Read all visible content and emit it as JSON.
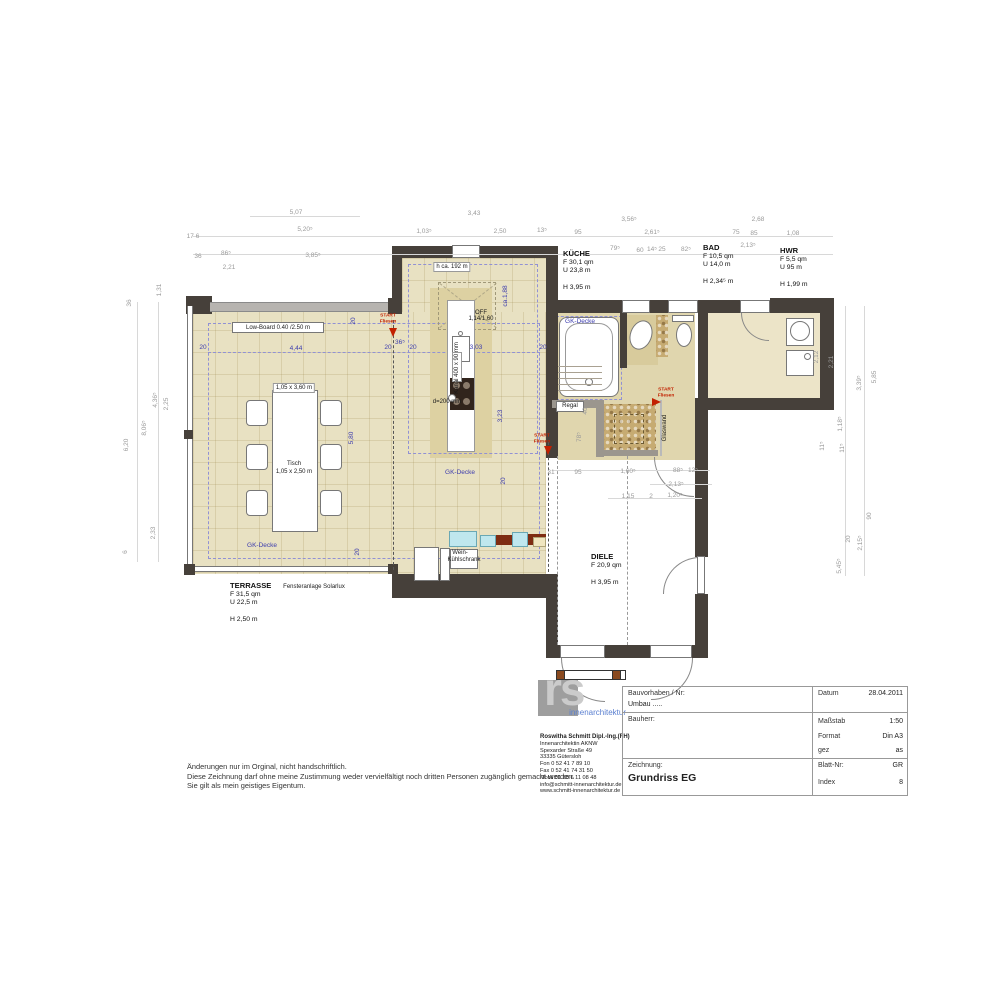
{
  "colors": {
    "wall": "#46403a",
    "floor_beige": "#e8e1c2",
    "accent_blue": "#3c3cae",
    "accent_red": "#c22000",
    "cabinet_blue": "#bfe7ee",
    "cabinet_brown": "#7e2c12",
    "pebble_tan": "#c6ab72",
    "logo_blue": "#5a7fd0",
    "logo_gray": "#9e9e9e"
  },
  "notes": [
    "Änderungen nur im Orginal, nicht handschriftlich.",
    "Diese Zeichnung darf ohne meine Zustimmung weder vervielfältigt noch dritten Personen zugänglich gemacht werden.",
    "Sie gilt als mein geistiges Eigentum."
  ],
  "logo": {
    "mark": "rs",
    "tagline": "innenarchitektur",
    "contact_lines": [
      "Roswitha Schmitt Dipl.-Ing.(FH)",
      "Innenarchitektin AKNW",
      "Spexarder Straße 49",
      "33335 Gütersloh",
      "Fon   0 52 41 7 89 10",
      "Fax   0 52 41 74 31 50",
      "Mobil 01 60 6 11 08 48",
      "info@schmitt-innenarchitektur.de",
      "www.schmitt-innenarchitektur.de"
    ]
  },
  "title_block": {
    "project_label": "Bauvorhaben / Nr:",
    "project_value": "Umbau .....",
    "client_label": "Bauherr:",
    "drawing_label": "Zeichnung:",
    "drawing_value": "Grundriss EG",
    "fields": [
      {
        "label": "Datum",
        "value": "28.04.2011"
      },
      {
        "label": "Maßstab",
        "value": "1:50"
      },
      {
        "label": "Format",
        "value": "Din A3"
      },
      {
        "label": "gez",
        "value": "as"
      },
      {
        "label": "Blatt-Nr:",
        "value": "GR"
      },
      {
        "label": "Index",
        "value": "8"
      }
    ]
  },
  "rooms": [
    {
      "name": "KÜCHE",
      "x": 563,
      "y": 250,
      "lines": [
        "F 30,1 qm",
        "U 23,8 m",
        "",
        "H 3,95 m"
      ]
    },
    {
      "name": "BAD",
      "x": 703,
      "y": 244,
      "lines": [
        "F 10,5 qm",
        "U 14,0 m",
        "",
        "H 2,34⁵ m"
      ]
    },
    {
      "name": "HWR",
      "x": 780,
      "y": 247,
      "lines": [
        "F 5,5 qm",
        "U 95 m",
        "",
        "H 1,99 m"
      ]
    },
    {
      "name": "DIELE",
      "x": 591,
      "y": 553,
      "lines": [
        "F 20,9 qm",
        "",
        "H 3,95 m"
      ]
    },
    {
      "name": "TERRASSE",
      "x": 230,
      "y": 582,
      "lines": [
        "F 31,5 qm",
        "U 22,5 m",
        "",
        "H 2,50 m"
      ]
    }
  ],
  "annotations": [
    {
      "t": "5,07",
      "x": 296,
      "y": 213
    },
    {
      "t": "17 6",
      "x": 193,
      "y": 237
    },
    {
      "t": "5,20⁵",
      "x": 305,
      "y": 230
    },
    {
      "t": "36",
      "x": 198,
      "y": 257
    },
    {
      "t": "86⁵",
      "x": 226,
      "y": 254
    },
    {
      "t": "2,21",
      "x": 229,
      "y": 268
    },
    {
      "t": "3,85⁵",
      "x": 313,
      "y": 256
    },
    {
      "t": "1,03⁵",
      "x": 424,
      "y": 232
    },
    {
      "t": "3,43",
      "x": 474,
      "y": 214
    },
    {
      "t": "2,50",
      "x": 500,
      "y": 232
    },
    {
      "t": "13⁵",
      "x": 542,
      "y": 231
    },
    {
      "t": "95",
      "x": 578,
      "y": 233
    },
    {
      "t": "3,56⁵",
      "x": 629,
      "y": 220
    },
    {
      "t": "2,61⁵",
      "x": 652,
      "y": 233
    },
    {
      "t": "79⁵",
      "x": 615,
      "y": 249
    },
    {
      "t": "60",
      "x": 640,
      "y": 251
    },
    {
      "t": "14⁵",
      "x": 652,
      "y": 250
    },
    {
      "t": "25",
      "x": 662,
      "y": 250
    },
    {
      "t": "82⁵",
      "x": 686,
      "y": 250
    },
    {
      "t": "2,13⁵",
      "x": 748,
      "y": 246
    },
    {
      "t": "2,68",
      "x": 758,
      "y": 220
    },
    {
      "t": "75",
      "x": 736,
      "y": 233
    },
    {
      "t": "85",
      "x": 754,
      "y": 234
    },
    {
      "t": "1,08",
      "x": 793,
      "y": 234
    },
    {
      "t": "1,31",
      "x": 160,
      "y": 290,
      "r": 1
    },
    {
      "t": "36",
      "x": 130,
      "y": 303,
      "r": 1
    },
    {
      "t": "4,36⁵",
      "x": 156,
      "y": 400,
      "r": 1
    },
    {
      "t": "2,25",
      "x": 167,
      "y": 404,
      "r": 1
    },
    {
      "t": "8,06⁵",
      "x": 145,
      "y": 428,
      "r": 1
    },
    {
      "t": "6,20",
      "x": 127,
      "y": 445,
      "r": 1
    },
    {
      "t": "2,33",
      "x": 154,
      "y": 533,
      "r": 1
    },
    {
      "t": "6",
      "x": 126,
      "y": 552,
      "r": 1
    },
    {
      "t": "2,12",
      "x": 817,
      "y": 357,
      "r": 1
    },
    {
      "t": "2,21",
      "x": 832,
      "y": 362,
      "r": 1
    },
    {
      "t": "3,39⁵",
      "x": 860,
      "y": 383,
      "r": 1
    },
    {
      "t": "5,85",
      "x": 875,
      "y": 377,
      "r": 1
    },
    {
      "t": "1,18⁵",
      "x": 841,
      "y": 424,
      "r": 1
    },
    {
      "t": "11⁵",
      "x": 823,
      "y": 446,
      "r": 1
    },
    {
      "t": "11⁵",
      "x": 843,
      "y": 448,
      "r": 1
    },
    {
      "t": "90",
      "x": 870,
      "y": 516,
      "r": 1
    },
    {
      "t": "20",
      "x": 849,
      "y": 539,
      "r": 1
    },
    {
      "t": "2,15⁵",
      "x": 861,
      "y": 543,
      "r": 1
    },
    {
      "t": "5,45⁵",
      "x": 840,
      "y": 566,
      "r": 1
    },
    {
      "t": "31",
      "x": 551,
      "y": 473
    },
    {
      "t": "95",
      "x": 578,
      "y": 473
    },
    {
      "t": "1,60⁵",
      "x": 628,
      "y": 472
    },
    {
      "t": "88⁵",
      "x": 678,
      "y": 471
    },
    {
      "t": "12⁵",
      "x": 693,
      "y": 471
    },
    {
      "t": "2,13⁵",
      "x": 676,
      "y": 485
    },
    {
      "t": "1,15",
      "x": 628,
      "y": 497
    },
    {
      "t": "2",
      "x": 651,
      "y": 497
    },
    {
      "t": "1,20⁵",
      "x": 675,
      "y": 496
    },
    {
      "t": "78⁵",
      "x": 580,
      "y": 437,
      "r": 1
    },
    {
      "t": "40",
      "x": 586,
      "y": 411,
      "r": 1
    },
    {
      "t": "20",
      "x": 203,
      "y": 348,
      "c": "b"
    },
    {
      "t": "4,44",
      "x": 296,
      "y": 349,
      "c": "b"
    },
    {
      "t": "20",
      "x": 388,
      "y": 348,
      "c": "b"
    },
    {
      "t": "36⁵",
      "x": 400,
      "y": 343,
      "c": "b"
    },
    {
      "t": "20",
      "x": 413,
      "y": 348,
      "c": "b"
    },
    {
      "t": "3,03",
      "x": 476,
      "y": 348,
      "c": "b"
    },
    {
      "t": "20",
      "x": 543,
      "y": 348,
      "c": "b"
    },
    {
      "t": "ca.1,88",
      "x": 506,
      "y": 296,
      "c": "b",
      "r": 1
    },
    {
      "t": "3,23",
      "x": 501,
      "y": 416,
      "c": "b",
      "r": 1
    },
    {
      "t": "5,80",
      "x": 352,
      "y": 438,
      "c": "b",
      "r": 1
    },
    {
      "t": "20",
      "x": 354,
      "y": 321,
      "c": "b",
      "r": 1
    },
    {
      "t": "20",
      "x": 504,
      "y": 481,
      "c": "b",
      "r": 1
    },
    {
      "t": "20",
      "x": 358,
      "y": 552,
      "c": "b",
      "r": 1
    },
    {
      "t": "GK-Decke",
      "x": 262,
      "y": 546,
      "c": "b"
    },
    {
      "t": "GK-Decke",
      "x": 460,
      "y": 473,
      "c": "b"
    },
    {
      "t": "GK-Decke",
      "x": 580,
      "y": 322,
      "c": "b"
    },
    {
      "t": "START",
      "x": 388,
      "y": 317,
      "c": "r"
    },
    {
      "t": "Fliesen",
      "x": 388,
      "y": 323,
      "c": "r"
    },
    {
      "t": "START",
      "x": 542,
      "y": 437,
      "c": "r"
    },
    {
      "t": "Fliesen",
      "x": 542,
      "y": 443,
      "c": "r"
    },
    {
      "t": "START",
      "x": 666,
      "y": 391,
      "c": "r"
    },
    {
      "t": "Fliesen",
      "x": 666,
      "y": 397,
      "c": "r"
    },
    {
      "t": "Low-Board 0.40 /2.50 m",
      "x": 278,
      "y": 328,
      "c": "k"
    },
    {
      "t": "1,05 x 3,60 m",
      "x": 294,
      "y": 388,
      "c": "k",
      "box": 1
    },
    {
      "t": "Tisch",
      "x": 294,
      "y": 464,
      "c": "k"
    },
    {
      "t": "1,05 x 2,50 m",
      "x": 294,
      "y": 472,
      "c": "k"
    },
    {
      "t": "h ca. 192 m",
      "x": 452,
      "y": 267,
      "c": "k",
      "box": 1
    },
    {
      "t": "OFF",
      "x": 481,
      "y": 313,
      "c": "k"
    },
    {
      "t": "1,14/1,60",
      "x": 481,
      "y": 319,
      "c": "k"
    },
    {
      "t": "d=200 mm",
      "x": 447,
      "y": 402,
      "c": "k"
    },
    {
      "t": "Kanal 400 x 90 mm",
      "x": 457,
      "y": 368,
      "c": "k",
      "r": 1
    },
    {
      "t": "Fensteranlage Solarlux",
      "x": 314,
      "y": 587,
      "c": "k"
    },
    {
      "t": "Regal",
      "x": 570,
      "y": 406,
      "c": "k"
    },
    {
      "t": "Glaswand",
      "x": 665,
      "y": 428,
      "c": "k",
      "r": 1
    },
    {
      "t": "Wein-",
      "x": 460,
      "y": 553,
      "c": "k"
    },
    {
      "t": "Kühlschrank",
      "x": 464,
      "y": 560,
      "c": "k"
    }
  ]
}
